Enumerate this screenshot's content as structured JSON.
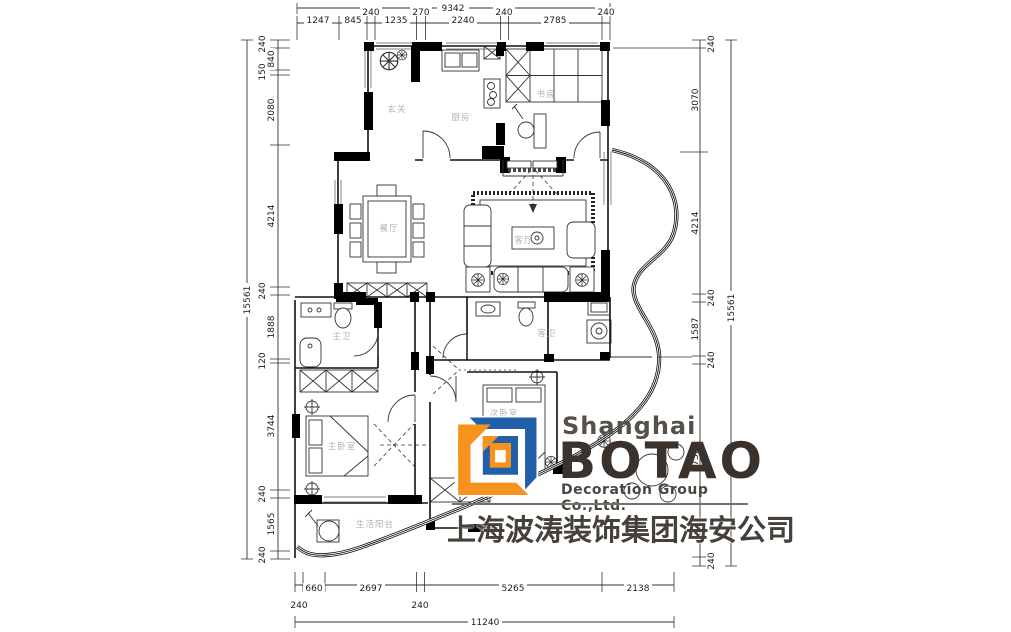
{
  "document": {
    "type": "residential floor plan drawing",
    "background": "#ffffff"
  },
  "logo": {
    "city": "Shanghai",
    "wordmark": "BOTAO",
    "subtitle": "Decoration Group Co.,Ltd.",
    "chinese_name": "上海波涛装饰集团海安公司",
    "colors": {
      "orange": "#F6921E",
      "blue": "#2160A8",
      "text_dark": "#3A332D",
      "text_gray": "#56504A"
    }
  },
  "rooms": {
    "entry": "玄关",
    "kitchen": "厨房",
    "study": "书房",
    "dining": "餐厅",
    "living": "客厅",
    "master_bath": "主卫",
    "guest_bath": "客卫",
    "second_bedroom": "次卧室",
    "master_bedroom": "主卧室",
    "service_balcony": "生活阳台"
  },
  "dimensions": {
    "top": {
      "total": "9342",
      "segments": [
        "1247",
        "845",
        "240",
        "1235",
        "270",
        "2240",
        "240",
        "2785",
        "240"
      ]
    },
    "left": {
      "total": "15561",
      "segments": [
        "240",
        "840",
        "150",
        "2080",
        "4214",
        "240",
        "1888",
        "120",
        "3744",
        "240",
        "1565",
        "240"
      ]
    },
    "right": {
      "total": "15561",
      "segments": [
        "240",
        "3070",
        "4214",
        "240",
        "1587",
        "240",
        "5730",
        "240"
      ]
    },
    "bottom": {
      "total": "11240",
      "segments": [
        "240",
        "660",
        "2697",
        "240",
        "5265",
        "2138"
      ]
    }
  }
}
